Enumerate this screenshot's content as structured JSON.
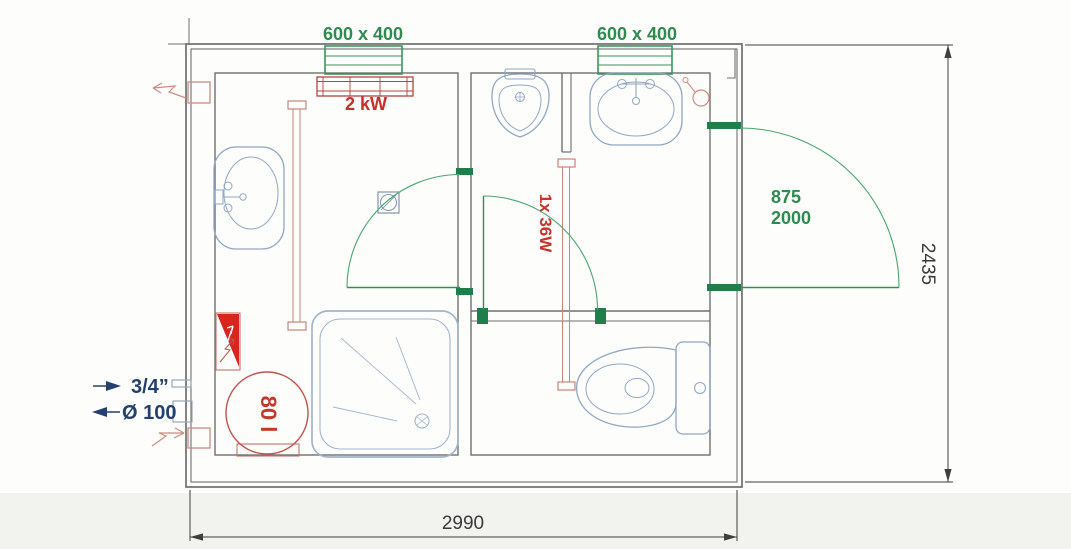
{
  "plan": {
    "title": "sanitary-container-floor-plan",
    "windows": {
      "left_label": "600 x 400",
      "right_label": "600 x 400"
    },
    "heater_label": "2 kW",
    "entry_door": {
      "width_label": "875",
      "height_label": "2000"
    },
    "light_label": "1x 36W",
    "boiler_label": "80 l",
    "connections": {
      "water_label": "3/4”",
      "sewage_label": "Ø 100"
    },
    "dimensions": {
      "width_label": "2990",
      "height_label": "2435"
    },
    "colors": {
      "green": "#2f8f5b",
      "red_text": "#c92f26",
      "pink_red": "#c4736c",
      "solid_red": "#d7261d",
      "fixture_blue": "#97abc5",
      "wall_gray": "#6f6f6f",
      "dimension_gray": "#3f3f3f",
      "navy": "#24406e"
    }
  }
}
